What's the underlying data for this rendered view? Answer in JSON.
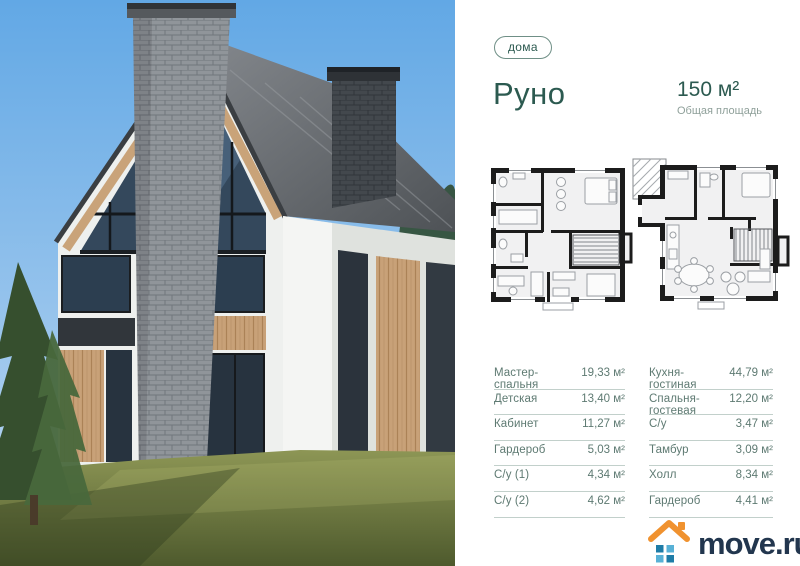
{
  "badge": {
    "label": "дома"
  },
  "header": {
    "title": "Руно",
    "area_value": "150 м²",
    "area_label": "Общая площадь"
  },
  "rooms_left": [
    {
      "label": "Мастер-спальня",
      "value": "19,33 м²"
    },
    {
      "label": "Детская",
      "value": "13,40 м²"
    },
    {
      "label": "Кабинет",
      "value": "11,27 м²"
    },
    {
      "label": "Гардероб",
      "value": "5,03 м²"
    },
    {
      "label": "С/у (1)",
      "value": "4,34 м²"
    },
    {
      "label": "С/у (2)",
      "value": "4,62 м²"
    }
  ],
  "rooms_right": [
    {
      "label": "Кухня-гостиная",
      "value": "44,79 м²"
    },
    {
      "label": "Спальня-гостевая",
      "value": "12,20 м²"
    },
    {
      "label": "С/у",
      "value": "3,47 м²"
    },
    {
      "label": "Тамбур",
      "value": "3,09 м²"
    },
    {
      "label": "Холл",
      "value": "8,34 м²"
    },
    {
      "label": "Гардероб",
      "value": "4,41 м²"
    }
  ],
  "logo": {
    "text": "move.ru"
  },
  "icons": {
    "logo_icon": "house-icon",
    "plan_left": "floor-plan-upper",
    "plan_right": "floor-plan-ground"
  },
  "colors": {
    "accent_teal": "#2c5a50",
    "table_text": "#5e7a72",
    "divider": "#c2d0cb",
    "logo_navy": "#22364e",
    "logo_orange": "#f0922f",
    "logo_blue_dark": "#1e7ca7",
    "logo_blue_light": "#58b1d6"
  }
}
